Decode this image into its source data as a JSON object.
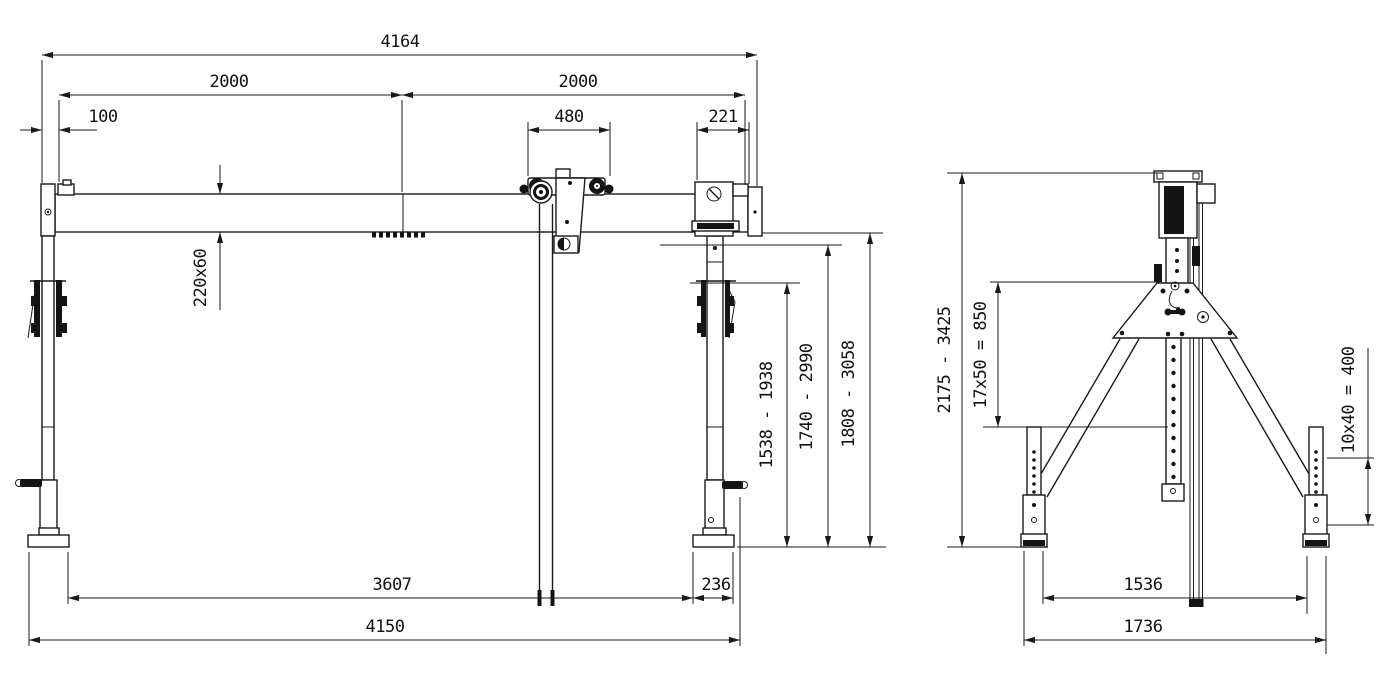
{
  "page": {
    "background_color": "#ffffff",
    "line_color": "#1a1a1a",
    "description": "Two-view technical dimension drawing of an adjustable portal gantry crane with chain hoist trolley"
  },
  "front_view": {
    "dims": {
      "overall_width": "4164",
      "span_left": "2000",
      "span_right": "2000",
      "left_offset": "100",
      "trolley_width": "480",
      "end_bracket_width": "221",
      "beam_section": "220x60",
      "hook_height_range": "1538 - 1938",
      "lift_height_range": "1740 - 2990",
      "clearance_height_range": "1808 - 3058",
      "base_inner_span": "3607",
      "foot_length": "236",
      "base_overall_span": "4150"
    }
  },
  "side_view": {
    "dims": {
      "overall_height_range": "2175 - 3425",
      "mast_hole_pattern": "17x50 = 850",
      "leg_hole_pattern": "10x40 = 400",
      "base_inner_width": "1536",
      "base_overall_width": "1736"
    }
  }
}
